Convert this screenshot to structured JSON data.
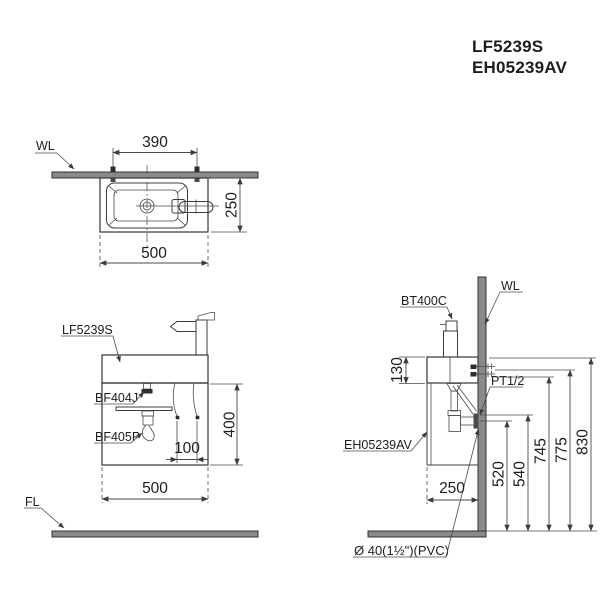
{
  "title": {
    "model_1": "LF5239S",
    "model_2": "EH05239AV"
  },
  "top_view": {
    "wall_label": "WL",
    "dim_hole_spacing": "390",
    "dim_depth": "250",
    "dim_width": "500"
  },
  "front_view": {
    "basin_label": "LF5239S",
    "drain_fitting_label": "BF404J",
    "trap_label": "BF405P",
    "dim_hose_spacing": "100",
    "dim_height": "400",
    "dim_width": "500",
    "floor_label": "FL"
  },
  "side_view": {
    "faucet_label": "BT400C",
    "wall_label": "WL",
    "supply_label": "PT1/2",
    "cabinet_label": "EH05239AV",
    "drain_pipe_label": "Ø 40(1½\")(PVC)",
    "dim_deck_height": "130",
    "dim_depth": "250",
    "dim_520": "520",
    "dim_540": "540",
    "dim_745": "745",
    "dim_775": "775",
    "dim_830": "830"
  },
  "colors": {
    "line": "#3c3c3c",
    "wall_fill": "#8a8a8a",
    "text": "#1d1d1d"
  }
}
